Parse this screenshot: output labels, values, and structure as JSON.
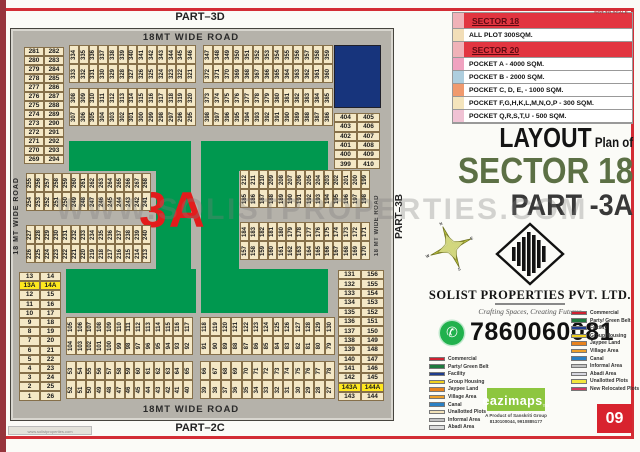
{
  "page": {
    "part_top": "PART–3D",
    "part_bottom": "PART–2C",
    "part_right": "PART–3B",
    "not_to_scale": "NOT TO SCALE",
    "page_number": "09",
    "watermark": "WWW.SOLISTPROPERTIES.COM",
    "watermark_small": "www.solistproperties.com"
  },
  "map": {
    "zone_label": "3A",
    "road_top": "18MT WIDE ROAD",
    "road_bottom": "18MT WIDE ROAD",
    "road_left": "18 MT WIDE ROAD",
    "road_right": "18 MT WIDE ROAD",
    "strips": {
      "ul1": [
        [
          334,
          335,
          336,
          337,
          338,
          339,
          340,
          341,
          342,
          343,
          344,
          345,
          346
        ],
        [
          333,
          332,
          331,
          330,
          329,
          328,
          327,
          326,
          325,
          324,
          323,
          322,
          321
        ]
      ],
      "ur1": [
        [
          347,
          348,
          349,
          350,
          351,
          352,
          353,
          354,
          355,
          356,
          357,
          358,
          359
        ],
        [
          372,
          371,
          370,
          369,
          368,
          367,
          366,
          365,
          364,
          363,
          362,
          361,
          360
        ]
      ],
      "ul2": [
        [
          308,
          309,
          310,
          311,
          312,
          313,
          314,
          315,
          316,
          317,
          318,
          319,
          320
        ],
        [
          307,
          306,
          305,
          304,
          303,
          302,
          301,
          300,
          299,
          298,
          297,
          296,
          295
        ]
      ],
      "ur2": [
        [
          373,
          374,
          375,
          376,
          377,
          378,
          379,
          380,
          381,
          382,
          383,
          384,
          385
        ],
        [
          398,
          397,
          396,
          395,
          394,
          393,
          392,
          391,
          390,
          389,
          388,
          387,
          386
        ]
      ],
      "ml1": [
        [
          255,
          256,
          257,
          258,
          259,
          260,
          261,
          262,
          263,
          264,
          265,
          266,
          267,
          268
        ],
        [
          254,
          253,
          252,
          251,
          250,
          249,
          248,
          247,
          246,
          245,
          244,
          243,
          242,
          241
        ]
      ],
      "ml2": [
        [
          227,
          228,
          229,
          230,
          231,
          232,
          233,
          234,
          235,
          236,
          237,
          238,
          239,
          240
        ],
        [
          226,
          225,
          224,
          223,
          222,
          221,
          220,
          219,
          218,
          217,
          216,
          215,
          214,
          213
        ]
      ],
      "mr1": [
        [
          212,
          211,
          210,
          209,
          208,
          207,
          206,
          205,
          204,
          203,
          202,
          201,
          200,
          199
        ],
        [
          185,
          186,
          187,
          188,
          189,
          190,
          191,
          192,
          193,
          194,
          195,
          196,
          197,
          198
        ]
      ],
      "mr2": [
        [
          184,
          183,
          182,
          181,
          180,
          179,
          178,
          177,
          176,
          175,
          174,
          173,
          172,
          171
        ],
        [
          157,
          158,
          159,
          160,
          161,
          162,
          163,
          164,
          165,
          166,
          167,
          168,
          169,
          170
        ]
      ],
      "bl1": [
        [
          105,
          106,
          107,
          108,
          109,
          110,
          111,
          112,
          113,
          114,
          115,
          116,
          117
        ],
        [
          104,
          103,
          102,
          101,
          100,
          99,
          98,
          97,
          96,
          95,
          94,
          93,
          92
        ]
      ],
      "br1": [
        [
          118,
          119,
          120,
          121,
          122,
          123,
          124,
          125,
          126,
          127,
          128,
          129,
          130
        ],
        [
          91,
          90,
          89,
          88,
          87,
          86,
          85,
          84,
          83,
          82,
          81,
          80,
          79
        ]
      ],
      "bl2": [
        [
          53,
          54,
          55,
          56,
          57,
          58,
          59,
          60,
          61,
          62,
          63,
          64,
          65
        ],
        [
          52,
          51,
          50,
          49,
          48,
          47,
          46,
          45,
          44,
          43,
          42,
          41,
          40
        ]
      ],
      "br2": [
        [
          66,
          67,
          68,
          69,
          70,
          71,
          72,
          73,
          74,
          75,
          76,
          77,
          78
        ],
        [
          39,
          38,
          37,
          36,
          35,
          34,
          33,
          32,
          31,
          30,
          29,
          28,
          27
        ]
      ]
    },
    "pairs": {
      "tl": [
        [
          281,
          282
        ],
        [
          280,
          283
        ],
        [
          279,
          284
        ],
        [
          278,
          285
        ],
        [
          277,
          286
        ],
        [
          276,
          287
        ],
        [
          275,
          288
        ],
        [
          274,
          289
        ],
        [
          273,
          290
        ],
        [
          272,
          291
        ],
        [
          271,
          292
        ],
        [
          270,
          293
        ],
        [
          269,
          294
        ]
      ],
      "tr": [
        [
          404,
          405
        ],
        [
          403,
          406
        ],
        [
          402,
          407
        ],
        [
          401,
          408
        ],
        [
          400,
          409
        ],
        [
          399,
          410
        ]
      ],
      "bl": [
        [
          13,
          14
        ],
        [
          "13A",
          "14A"
        ],
        [
          12,
          15
        ],
        [
          11,
          16
        ],
        [
          10,
          17
        ],
        [
          9,
          18
        ],
        [
          8,
          19
        ],
        [
          7,
          20
        ],
        [
          6,
          21
        ],
        [
          5,
          22
        ],
        [
          4,
          23
        ],
        [
          3,
          24
        ],
        [
          2,
          25
        ],
        [
          1,
          26
        ]
      ],
      "br": [
        [
          131,
          156
        ],
        [
          132,
          155
        ],
        [
          133,
          154
        ],
        [
          134,
          153
        ],
        [
          135,
          152
        ],
        [
          136,
          151
        ],
        [
          137,
          150
        ],
        [
          138,
          149
        ],
        [
          139,
          148
        ],
        [
          140,
          147
        ],
        [
          141,
          146
        ],
        [
          142,
          145
        ],
        [
          "143A",
          "144A"
        ],
        [
          143,
          144
        ]
      ]
    }
  },
  "legend_top": {
    "sector18_title": "SECTOR 18",
    "sector18_rows": [
      {
        "color": "#f2deb8",
        "label": "ALL PLOT  300SQM."
      }
    ],
    "sector20_title": "SECTOR 20",
    "sector20_rows": [
      {
        "color": "#f0a2c0",
        "label": "POCKET A    -   4000 SQM."
      },
      {
        "color": "#aecede",
        "label": "POCKET B    -   2000 SQM."
      },
      {
        "color": "#f09a6e",
        "label": "POCKET C, D, E, - 1000 SQM."
      },
      {
        "color": "#f4e4bc",
        "label": "POCKET  F,G,H,K,L,M,N,O,P   -   300 SQM."
      },
      {
        "color": "#f0c2d4",
        "label": "POCKET Q,R,S,T,U    -   500 SQM."
      }
    ]
  },
  "title_block": {
    "word1": "LAYOUT",
    "word2": "Plan of",
    "line2": "SECTOR 18",
    "line3": "PART -3A"
  },
  "company": {
    "name": "SOLIST PROPERTIES PVT. LTD.",
    "tagline": "Crafting Spaces, Creating Futures",
    "phone": "7860060081"
  },
  "compass": {
    "n": "N",
    "e": "E",
    "s": "S",
    "w": "W"
  },
  "legend_left": {
    "items": [
      {
        "color": "#cf2030",
        "label": "Commercial"
      },
      {
        "color": "#1e7a3e",
        "label": "Party/ Green Belt"
      },
      {
        "color": "#1e3c8c",
        "label": "Facility"
      },
      {
        "color": "#f0d020",
        "label": "Group Housing"
      },
      {
        "color": "#e8821e",
        "label": "Jaypee Land"
      },
      {
        "color": "#f0a028",
        "label": "Village Area"
      },
      {
        "color": "#2a80c4",
        "label": "Canal"
      },
      {
        "color": "#f2e2b8",
        "label": "Unallotted Plots"
      },
      {
        "color": "#c2c2c2",
        "label": "Informal Area"
      },
      {
        "color": "#dcdcdc",
        "label": "Abadi Area"
      }
    ]
  },
  "legend_right": {
    "items": [
      {
        "color": "#cf2030",
        "label": "Commercial"
      },
      {
        "color": "#1e7a3e",
        "label": "Party/ Green Belt"
      },
      {
        "color": "#1e3c8c",
        "label": "Facility"
      },
      {
        "color": "#f0d020",
        "label": "Group Housing"
      },
      {
        "color": "#e8821e",
        "label": "Jaypee Land"
      },
      {
        "color": "#f0a028",
        "label": "Village Area"
      },
      {
        "color": "#2a80c4",
        "label": "Canal"
      },
      {
        "color": "#c2c2c2",
        "label": "Informal Area"
      },
      {
        "color": "#d8d8e0",
        "label": "Abadi Area"
      },
      {
        "color": "#f2e63c",
        "label": "Unallotted Plots"
      },
      {
        "color": "#d23a60",
        "label": "New Relocated Plots"
      }
    ]
  },
  "eazimaps": {
    "brand": "eazimaps",
    "tm": "TM",
    "sub1": "A Product of Sanskriti Group",
    "sub2": "8130100044, 9910885177"
  },
  "colors": {
    "accent": "#d32d35",
    "green": "#00984f",
    "road": "#b5b2aa",
    "plot": "#f4e8c6",
    "highlight": "#ffe81e",
    "facility": "#17347c",
    "titlegreen": "#5c7045",
    "brand": "#8dc63f",
    "phonegreen": "#21b14d",
    "zone_red": "#e31c1c"
  }
}
